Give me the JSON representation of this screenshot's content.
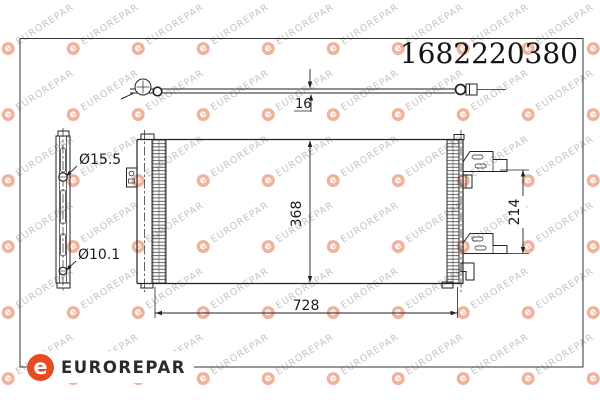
{
  "part_number": "1682220380",
  "brand": {
    "name": "EUROREPAR",
    "logo_letter": "e",
    "logo_icon": "eurorepar-e-icon"
  },
  "watermark": {
    "text": "EUROREPAR",
    "badge_letter": "e"
  },
  "dimensions": {
    "depth": "16",
    "core_height": "368",
    "core_width": "728",
    "bracket_spacing": "214",
    "upper_port_diameter": "Ø15.5",
    "lower_port_diameter": "Ø10.1"
  },
  "colors": {
    "accent": "#e8491f",
    "line": "#222222",
    "frame": "#333333",
    "watermark_text": "#c7c5c4",
    "watermark_badge": "#f1b29b"
  }
}
